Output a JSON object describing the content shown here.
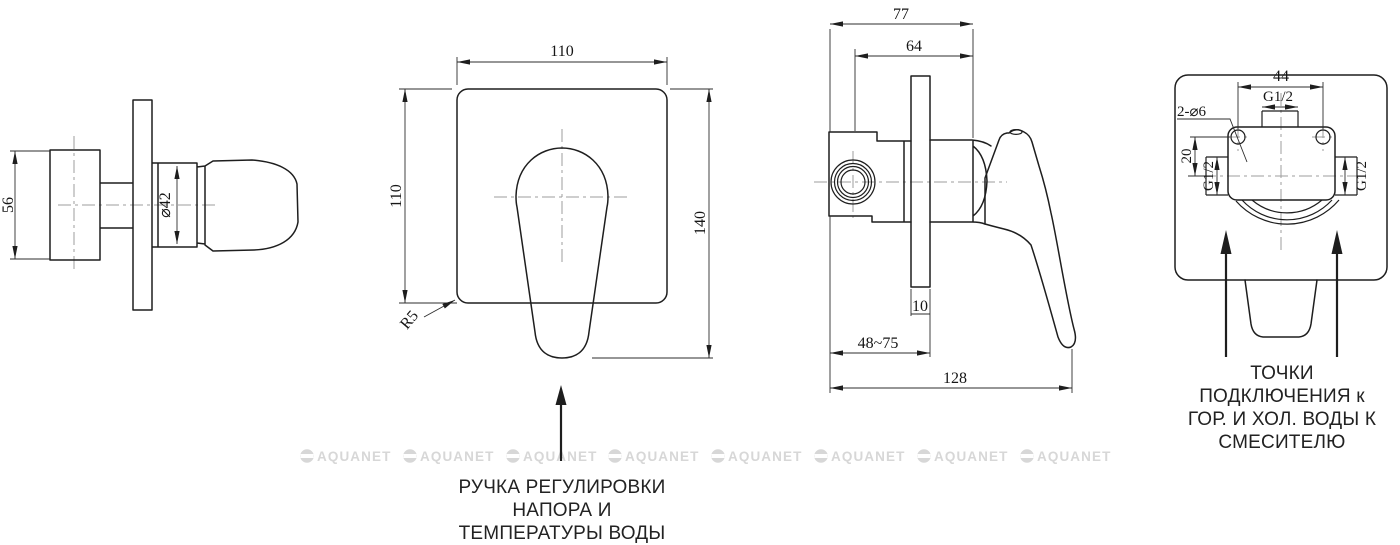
{
  "document": {
    "type": "technical drawing",
    "subject": "built-in shower mixer (смеситель) dimensional drawing"
  },
  "views": {
    "side": {
      "name": "side view",
      "dim_height": "56",
      "dim_diameter": "⌀42"
    },
    "front": {
      "name": "front view",
      "dim_width": "110",
      "dim_height": "110",
      "dim_total_height": "140",
      "dim_corner_radius": "R5",
      "annotation": [
        "РУЧКА РЕГУЛИРОВКИ",
        "НАПОРА И",
        "ТЕМПЕРАТУРЫ ВОДЫ"
      ]
    },
    "profile": {
      "name": "profile view",
      "dim_depth_total": "77",
      "dim_depth_body": "64",
      "dim_plate_thickness": "10",
      "dim_mount_range": "48~75",
      "dim_length": "128"
    },
    "back": {
      "name": "back view",
      "dim_hole_spacing": "44",
      "dim_thread_top": "G1/2",
      "dim_holes": "2-⌀6",
      "dim_offset": "20",
      "dim_thread_left": "G1/2",
      "dim_thread_right": "G1/2",
      "annotation": [
        "ТОЧКИ",
        "ПОДКЛЮЧЕНИЯ к",
        "ГОР. И ХОЛ. ВОДЫ К",
        "СМЕСИТЕЛЮ"
      ]
    }
  },
  "watermark": {
    "text": "AQUANET",
    "count": 8,
    "color": "#d7d7d7"
  }
}
